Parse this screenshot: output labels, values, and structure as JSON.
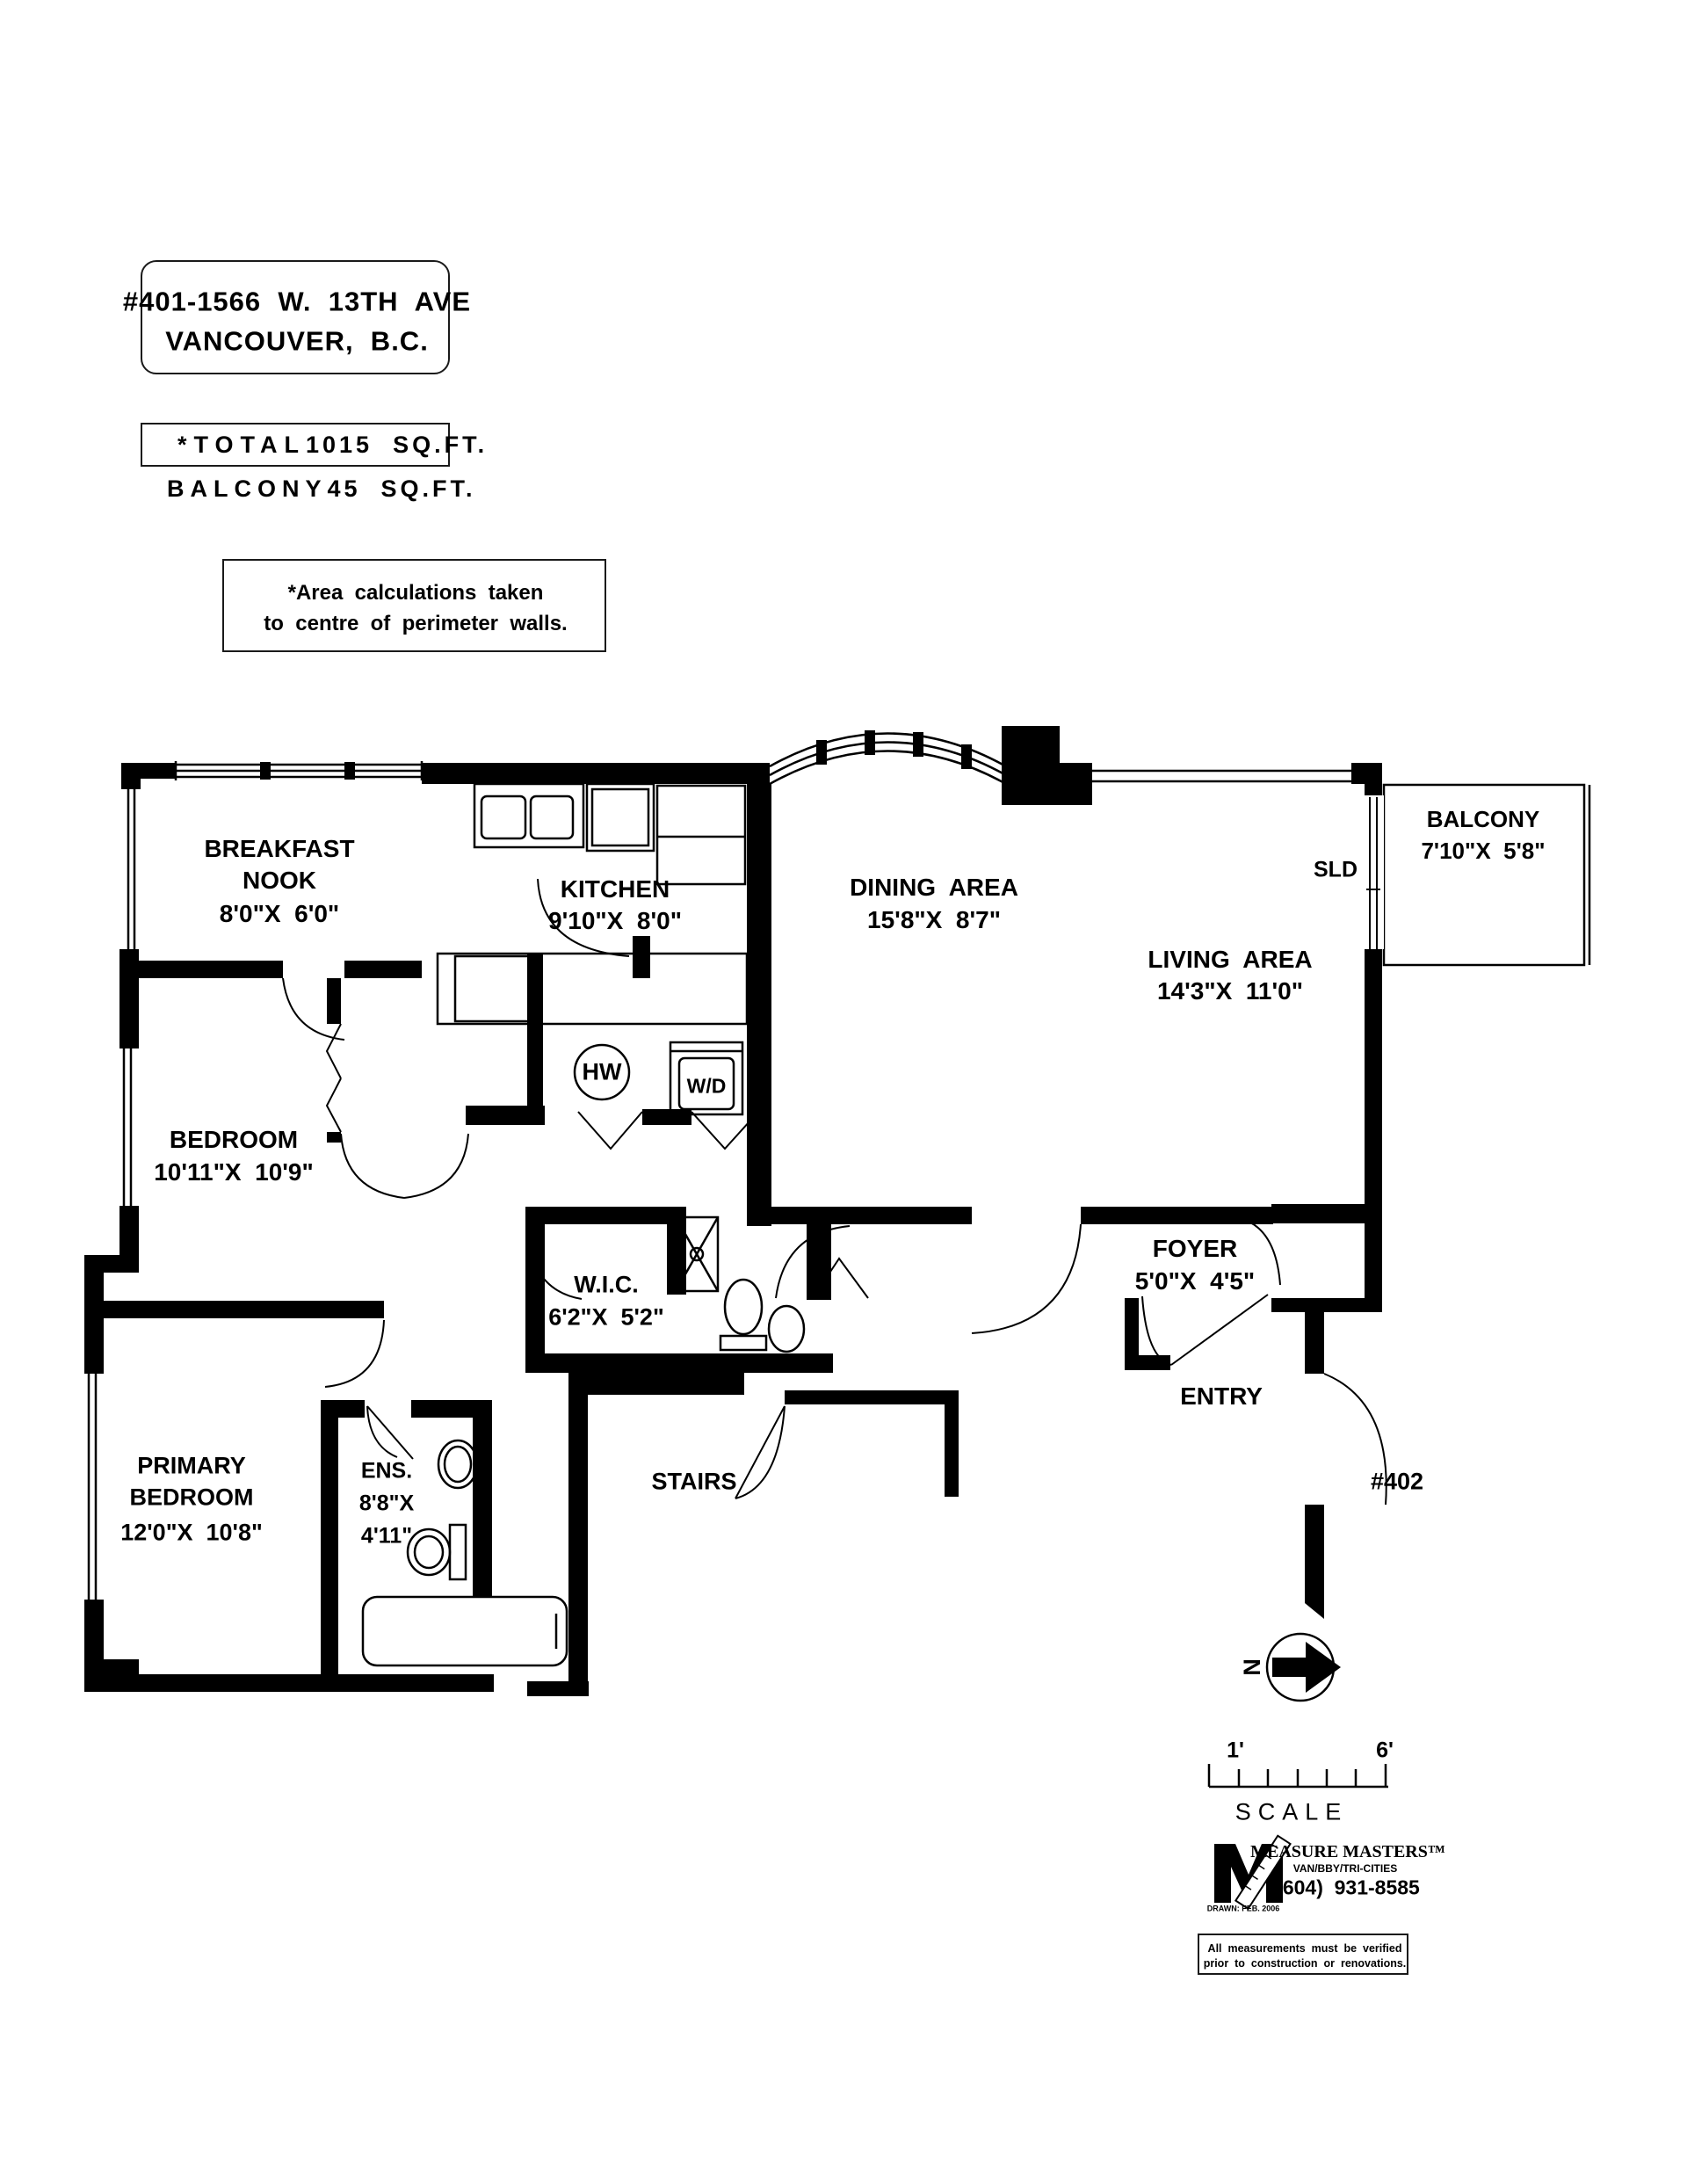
{
  "title": {
    "line1": "#401-1566  W.  13TH  AVE",
    "line2": "VANCOUVER,  B.C."
  },
  "areas": {
    "total_label": "*TOTAL",
    "total_value": "1015  SQ.FT.",
    "balcony_label": "BALCONY",
    "balcony_value": "45  SQ.FT."
  },
  "note": {
    "line1": "*Area  calculations  taken",
    "line2": "to  centre  of  perimeter  walls."
  },
  "rooms": {
    "breakfast_nook": {
      "line1": "BREAKFAST",
      "line2": "NOOK",
      "dims": "8'0\"X  6'0\""
    },
    "kitchen": {
      "name": "KITCHEN",
      "dims": "9'10\"X  8'0\""
    },
    "dining": {
      "name": "DINING  AREA",
      "dims": "15'8\"X  8'7\""
    },
    "living": {
      "name": "LIVING  AREA",
      "dims": "14'3\"X  11'0\""
    },
    "balcony": {
      "name": "BALCONY",
      "dims": "7'10\"X  5'8\""
    },
    "bedroom": {
      "name": "BEDROOM",
      "dims": "10'11\"X  10'9\""
    },
    "wic": {
      "name": "W.I.C.",
      "dims": "6'2\"X  5'2\""
    },
    "foyer": {
      "name": "FOYER",
      "dims": "5'0\"X  4'5\""
    },
    "primary_bedroom": {
      "line1": "PRIMARY",
      "line2": "BEDROOM",
      "dims": "12'0\"X  10'8\""
    },
    "ensuite": {
      "name": "ENS.",
      "dims_line1": "8'8\"X",
      "dims_line2": "4'11\""
    },
    "stairs": {
      "name": "STAIRS"
    },
    "entry": {
      "name": "ENTRY"
    },
    "neighbor_unit": {
      "name": "#402"
    }
  },
  "fixtures": {
    "hot_water_tank": "HW",
    "washer_dryer": "W/D",
    "sliding_door": "SLD"
  },
  "compass": {
    "north": "N"
  },
  "scale_bar": {
    "start": "1'",
    "end": "6'",
    "label": "SCALE"
  },
  "branding": {
    "company": "MEASURE MASTERS™",
    "regions": "VAN/BBY/TRI-CITIES",
    "phone": "(604)  931-8585",
    "drawn_note": "DRAWN: FEB. 2006"
  },
  "disclaimer": {
    "line1": "All  measurements  must  be  verified",
    "line2": "prior  to  construction  or  renovations."
  }
}
